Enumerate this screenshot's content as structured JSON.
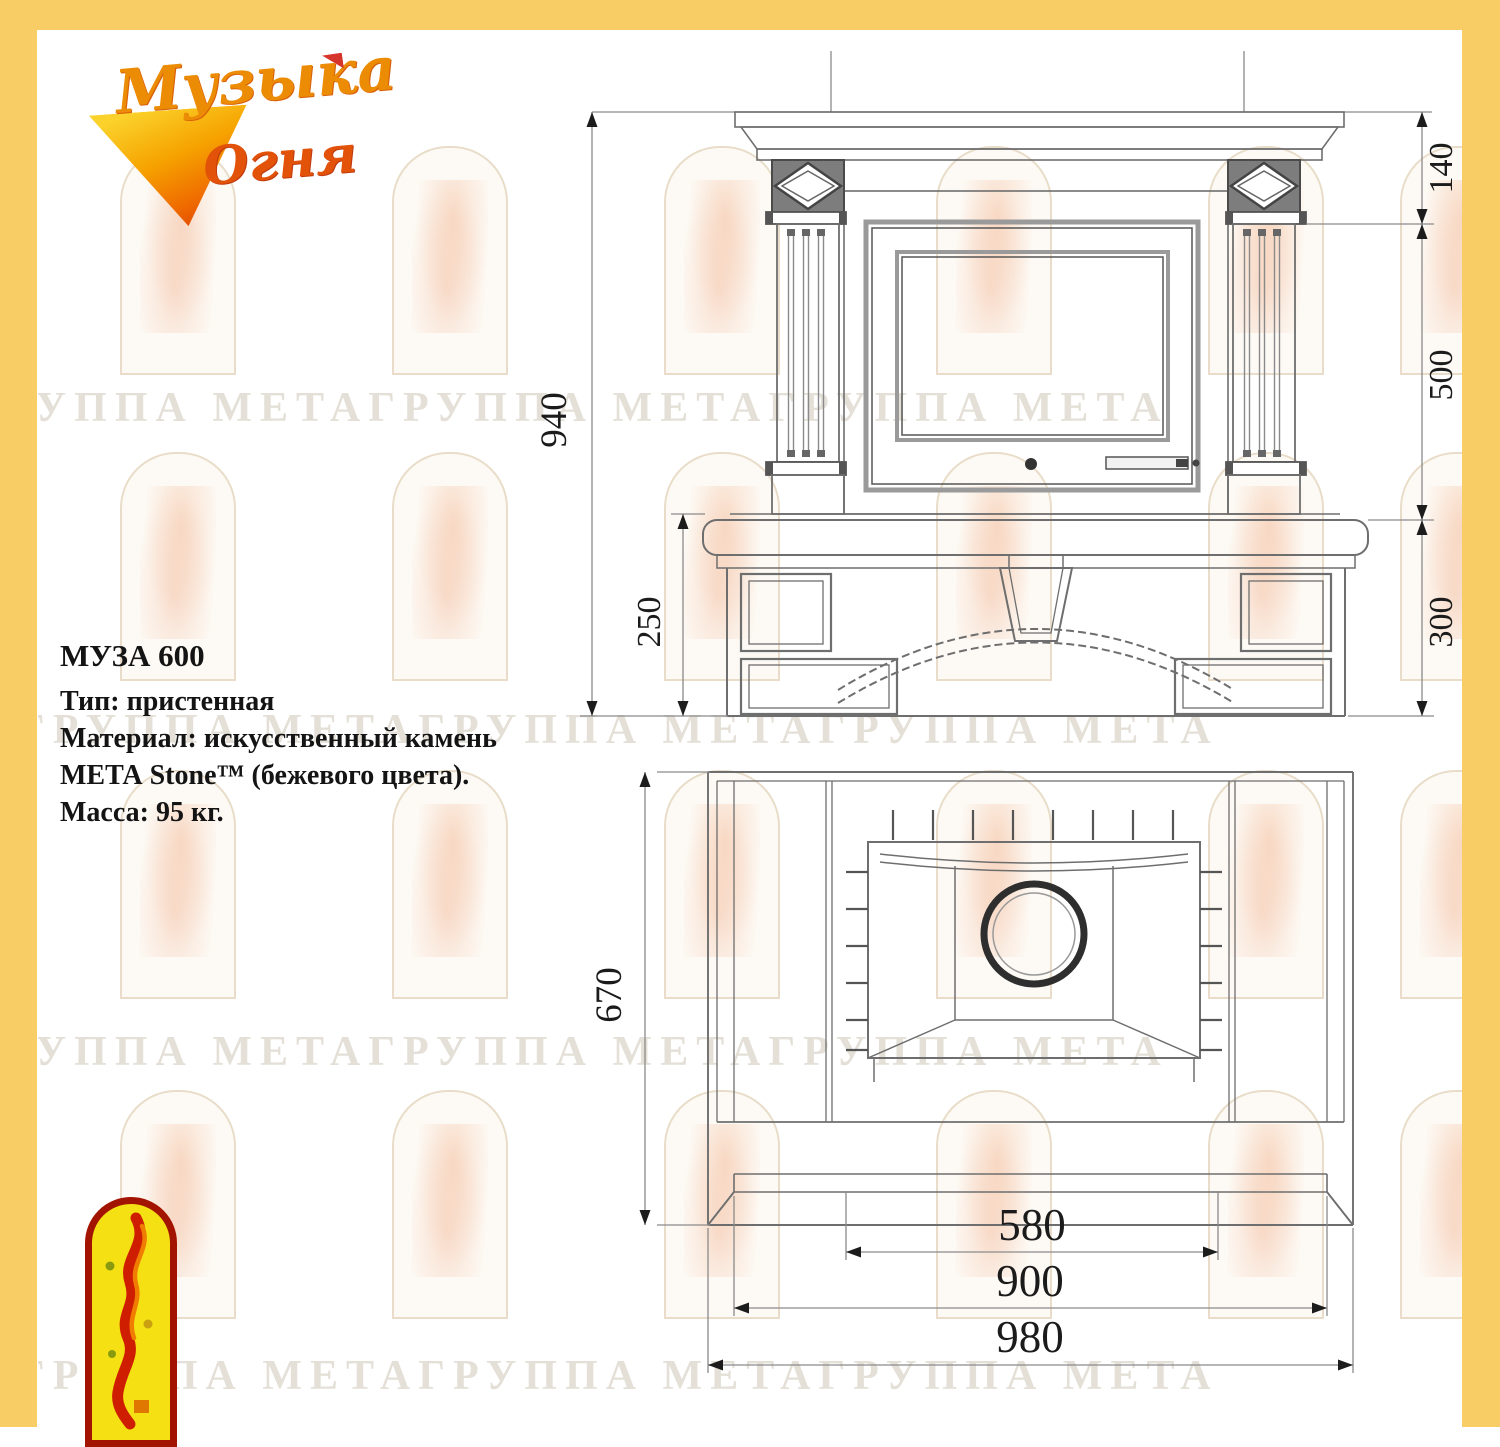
{
  "colors": {
    "border_yellow": "#f8cd65",
    "drawing_line": "#6e6e6e",
    "dimension_text": "#1b1b1b",
    "emblem_red": "#a21300",
    "emblem_yellow": "#f4e013"
  },
  "brand": {
    "name_line1": "Музыка",
    "name_line2": "Огня"
  },
  "specs": {
    "title": "МУЗА 600",
    "type": "Тип: пристенная",
    "material_1": "Материал: искусственный камень",
    "material_2": "МЕТА Stone™ (бежевого цвета).",
    "mass": "Масса: 95 кг."
  },
  "watermark": {
    "text": "ГРУППА МЕТАГРУППА МЕТАГРУППА МЕТА"
  },
  "dimensions": {
    "front_view": {
      "total_height": "940",
      "mantel_height": "140",
      "firebox_section_height": "500",
      "base_section_height": "300",
      "base_with_shelf_height": "250"
    },
    "plan_view": {
      "depth": "670",
      "opening_width": "580",
      "body_width": "900",
      "total_width": "980"
    }
  }
}
